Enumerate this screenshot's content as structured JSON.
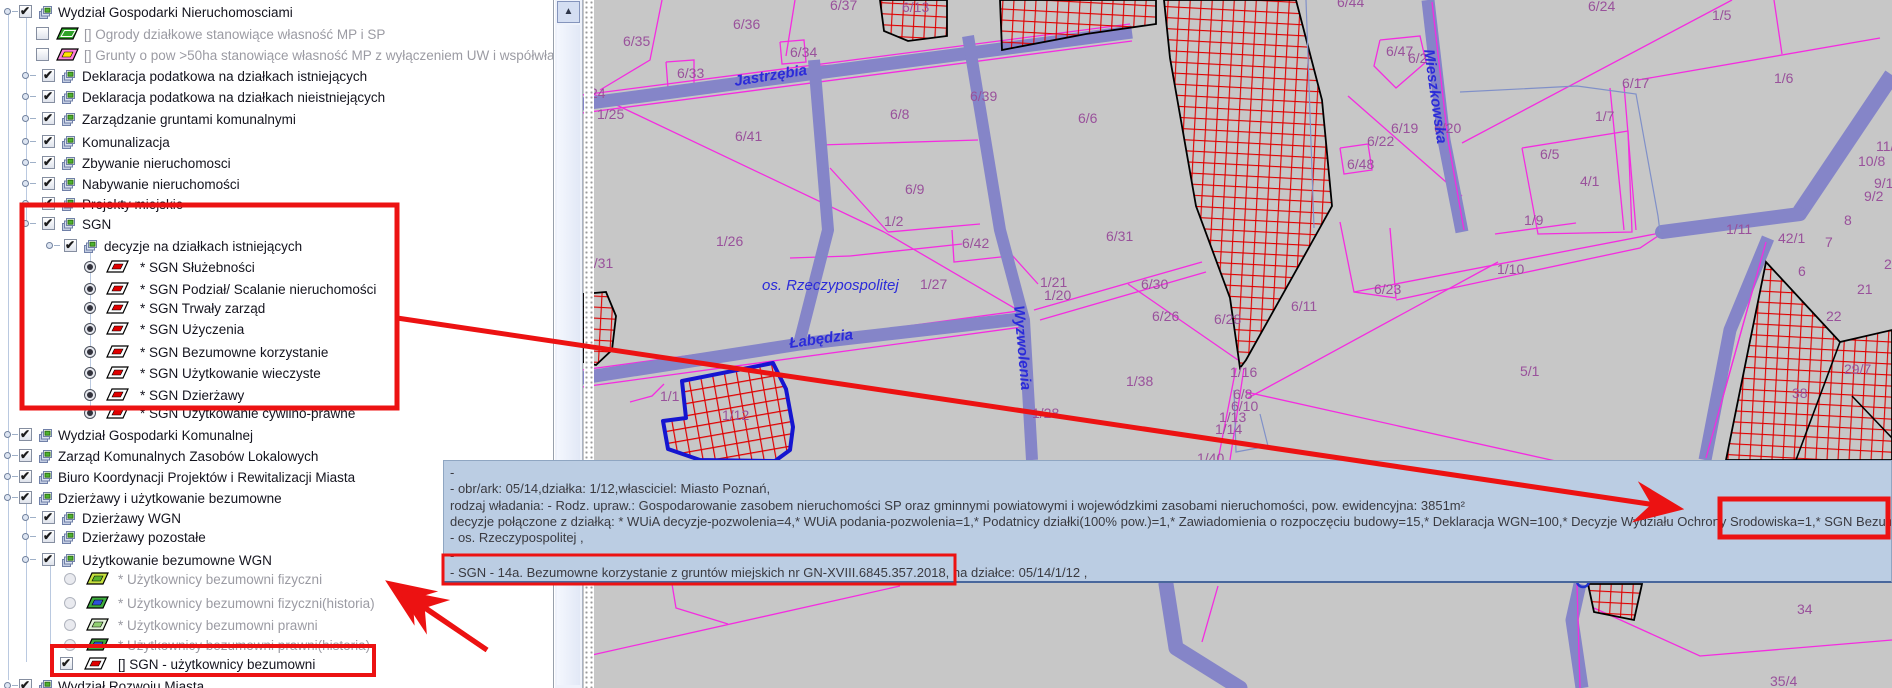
{
  "icons": {
    "scroll_up": "▲"
  },
  "layer_tree": {
    "rows": [
      {
        "y": 3,
        "hx": 4,
        "cx": 19,
        "ix": 37,
        "tx": 58,
        "c": "cb1",
        "icon": "layers",
        "label": "Wydział Gospodarki Nieruchomosciami"
      },
      {
        "y": 25,
        "cx": 36,
        "ix": 52,
        "tx": 84,
        "c": "cb0",
        "icon": "par",
        "f": "#2fa32a",
        "b": null,
        "label": "[] Ogrody działkowe stanowiące własność MP i SP",
        "dis": true
      },
      {
        "y": 46,
        "cx": 36,
        "ix": 52,
        "tx": 84,
        "c": "cb0",
        "icon": "par",
        "f": "#ff80d8",
        "b": "#ffe400",
        "label": "[] Grunty o pow >50ha stanowiące własność MP z wyłączeniem UW i współwłasności",
        "dis": true
      },
      {
        "y": 67,
        "hx": 22,
        "cx": 42,
        "ix": 60,
        "tx": 82,
        "c": "cb1",
        "icon": "layers",
        "label": "Deklaracja podatkowa na działkach istniejących"
      },
      {
        "y": 88,
        "hx": 22,
        "cx": 42,
        "ix": 60,
        "tx": 82,
        "c": "cb1",
        "icon": "layers",
        "label": "Deklaracja podatkowa na działkach nieistniejących"
      },
      {
        "y": 110,
        "hx": 22,
        "cx": 42,
        "ix": 60,
        "tx": 82,
        "c": "cb1",
        "icon": "layers",
        "label": "Zarządzanie gruntami komunalnymi"
      },
      {
        "y": 133,
        "hx": 22,
        "cx": 42,
        "ix": 60,
        "tx": 82,
        "c": "cb1",
        "icon": "layers",
        "label": "Komunalizacja"
      },
      {
        "y": 154,
        "hx": 22,
        "cx": 42,
        "ix": 60,
        "tx": 82,
        "c": "cb1",
        "icon": "layers",
        "label": "Zbywanie nieruchomosci"
      },
      {
        "y": 175,
        "hx": 22,
        "cx": 42,
        "ix": 60,
        "tx": 82,
        "c": "cb1",
        "icon": "layers",
        "label": "Nabywanie nieruchomości"
      },
      {
        "y": 195,
        "hx": 22,
        "cx": 42,
        "ix": 60,
        "tx": 82,
        "c": "cb1",
        "icon": "layers",
        "label": "Projekty miejskie"
      },
      {
        "y": 215,
        "hx": 22,
        "cx": 42,
        "ix": 60,
        "tx": 82,
        "c": "cb1",
        "icon": "layers",
        "label": "SGN"
      },
      {
        "y": 237,
        "hx": 46,
        "cx": 64,
        "ix": 82,
        "tx": 104,
        "c": "cb1",
        "icon": "layers",
        "label": "decyzje na działkach istniejących"
      },
      {
        "y": 258,
        "cx": 84,
        "ix": 102,
        "tx": 140,
        "c": "r1",
        "icon": "par",
        "f": "#ffffff",
        "b": "#e00000",
        "label": "* SGN Służebności"
      },
      {
        "y": 280,
        "cx": 84,
        "ix": 102,
        "tx": 140,
        "c": "r1",
        "icon": "par",
        "f": "#ffffff",
        "b": "#e00000",
        "label": "* SGN Podział/ Scalanie nieruchomości"
      },
      {
        "y": 299,
        "cx": 84,
        "ix": 102,
        "tx": 140,
        "c": "r1",
        "icon": "par",
        "f": "#ffffff",
        "b": "#e00000",
        "label": "* SGN Trwały zarząd"
      },
      {
        "y": 320,
        "cx": 84,
        "ix": 102,
        "tx": 140,
        "c": "r1",
        "icon": "par",
        "f": "#ffffff",
        "b": "#e00000",
        "label": "* SGN Użyczenia"
      },
      {
        "y": 343,
        "cx": 84,
        "ix": 102,
        "tx": 140,
        "c": "r1",
        "icon": "par",
        "f": "#ffffff",
        "b": "#e00000",
        "label": "* SGN Bezumowne korzystanie"
      },
      {
        "y": 364,
        "cx": 84,
        "ix": 102,
        "tx": 140,
        "c": "r1",
        "icon": "par",
        "f": "#ffffff",
        "b": "#e00000",
        "label": "* SGN Użytkowanie wieczyste"
      },
      {
        "y": 386,
        "cx": 84,
        "ix": 102,
        "tx": 140,
        "c": "r1",
        "icon": "par",
        "f": "#ffffff",
        "b": "#e00000",
        "label": "* SGN Dzierżawy"
      },
      {
        "y": 404,
        "cx": 84,
        "ix": 102,
        "tx": 140,
        "c": "r1",
        "icon": "par",
        "f": "#ffffff",
        "b": "#e00000",
        "label": "* SGN Użytkowanie cywilno-prawne"
      },
      {
        "y": 426,
        "hx": 4,
        "cx": 19,
        "ix": 37,
        "tx": 58,
        "c": "cb1",
        "icon": "layers",
        "label": "Wydział Gospodarki Komunalnej"
      },
      {
        "y": 447,
        "hx": 4,
        "cx": 19,
        "ix": 37,
        "tx": 58,
        "c": "cb1",
        "icon": "layers",
        "label": "Zarząd Komunalnych Zasobów Lokalowych"
      },
      {
        "y": 468,
        "hx": 4,
        "cx": 19,
        "ix": 37,
        "tx": 58,
        "c": "cb1",
        "icon": "layers",
        "label": "Biuro Koordynacji Projektów i Rewitalizacji Miasta"
      },
      {
        "y": 489,
        "hx": 4,
        "cx": 19,
        "ix": 37,
        "tx": 58,
        "c": "cb1",
        "icon": "layers",
        "label": "Dzierżawy i użytkowanie bezumowne"
      },
      {
        "y": 509,
        "hx": 22,
        "cx": 42,
        "ix": 60,
        "tx": 82,
        "c": "cb1",
        "icon": "layers",
        "label": "Dzierżawy WGN"
      },
      {
        "y": 528,
        "hx": 22,
        "cx": 42,
        "ix": 60,
        "tx": 82,
        "c": "cb1",
        "icon": "layers",
        "label": "Dzierżawy pozostałe"
      },
      {
        "y": 551,
        "hx": 22,
        "cx": 42,
        "ix": 60,
        "tx": 82,
        "c": "cb1",
        "icon": "layers",
        "label": "Użytkowanie bezumowne WGN"
      },
      {
        "y": 570,
        "cx": 64,
        "ix": 82,
        "tx": 118,
        "c": "r0",
        "icon": "par",
        "f": "#c6e23e",
        "b": "#5bb42c",
        "label": "* Użytkownicy bezumowni fizyczni",
        "dis": true
      },
      {
        "y": 594,
        "cx": 64,
        "ix": 82,
        "tx": 118,
        "c": "r0",
        "icon": "par",
        "f": "#3fae3f",
        "b": "#2d52da",
        "label": "* Użytkownicy bezumowni fizyczni(historia)",
        "dis": true
      },
      {
        "y": 616,
        "cx": 64,
        "ix": 82,
        "tx": 118,
        "c": "r0",
        "icon": "par",
        "f": "#e4f4da",
        "b": "#90d070",
        "label": "* Użytkownicy bezumowni prawni",
        "dis": true
      },
      {
        "y": 636,
        "cx": 64,
        "ix": 82,
        "tx": 118,
        "c": "r0",
        "icon": "par",
        "f": "#3fae3f",
        "b": "#2d52da",
        "label": "* Użytkownicy bezumowni prawni(historia)",
        "dis": true
      },
      {
        "y": 655,
        "cx": 60,
        "ix": 80,
        "tx": 118,
        "c": "cb1",
        "icon": "par",
        "f": "#ffffff",
        "b": "#e00000",
        "label": "[] SGN - użytkownicy bezumowni"
      },
      {
        "y": 677,
        "hx": 4,
        "cx": 19,
        "ix": 37,
        "tx": 58,
        "c": "cb1",
        "icon": "layers",
        "label": "Wydział Rozwoju Miasta"
      }
    ]
  },
  "map": {
    "bg": "#c7c7c7",
    "colors": {
      "parcel_line": "#f42ce0",
      "road": "#8585c8",
      "blue_line": "#8090c8",
      "hatch_border": "#000000",
      "label": "#99519b",
      "street": "#2b2bd9",
      "selected": "#1515d0"
    },
    "roads": [
      {
        "pts": "582,104 870,66 1132,32",
        "w": 13
      },
      {
        "pts": "814,60 828,230 800,340",
        "w": 12
      },
      {
        "pts": "968,36 1000,230 1024,320 1032,460",
        "w": 12
      },
      {
        "pts": "582,378 800,344 1028,318",
        "w": 13
      },
      {
        "pts": "1428,0 1444,140 1462,232",
        "w": 13
      },
      {
        "pts": "1892,75 1800,212",
        "w": 16
      },
      {
        "pts": "1800,214 1662,232",
        "w": 14,
        "cap": "round"
      },
      {
        "pts": "1768,238 1730,330 1705,460",
        "w": 13
      },
      {
        "pts": "1580,584 1572,620 1582,688",
        "w": 13
      },
      {
        "pts": "1166,584 1176,648 1240,688",
        "w": 15,
        "cap": "round"
      }
    ],
    "magenta_lines": [
      {
        "pts": "662,0 650,60 600,90"
      },
      {
        "pts": "795,0 786,56"
      },
      {
        "pts": "666,62 694,60 694,86 668,88 666,62"
      },
      {
        "pts": "780,42 804,40 806,62 782,64 780,42"
      },
      {
        "pts": "585,90 884,232"
      },
      {
        "pts": "884,232 1028,316"
      },
      {
        "pts": "820,66 980,56 1030,46"
      },
      {
        "pts": "820,145 978,140"
      },
      {
        "pts": "830,168 888,232"
      },
      {
        "pts": "888,232 980,224"
      },
      {
        "pts": "850,256 962,244"
      },
      {
        "pts": "952,230 954,262 1010,256"
      },
      {
        "pts": "790,258 850,256"
      },
      {
        "pts": "1034,310 1202,262"
      },
      {
        "pts": "1040,320 1206,272"
      },
      {
        "pts": "1128,284 1238,360"
      },
      {
        "pts": "1236,368 1218,460"
      },
      {
        "pts": "1244,368 1230,460"
      },
      {
        "pts": "1246,392 1560,462"
      },
      {
        "pts": "1248,398 1498,262"
      },
      {
        "pts": "1340,222 1354,292 1396,298 1390,228"
      },
      {
        "pts": "1354,292 1660,233"
      },
      {
        "pts": "1396,300 1640,248 1658,236"
      },
      {
        "pts": "1462,143 1732,0"
      },
      {
        "pts": "1638,80 1880,38"
      },
      {
        "pts": "1782,54 1774,0"
      },
      {
        "pts": "1522,148 1628,131 1632,232 1538,234 1522,148"
      },
      {
        "pts": "1610,88 1624,230"
      },
      {
        "pts": "1624,85 1636,230"
      },
      {
        "pts": "1495,234 1576,223"
      },
      {
        "pts": "592,655 900,586"
      },
      {
        "pts": "672,584 676,608 728,624"
      },
      {
        "pts": "1218,586 1202,642"
      },
      {
        "pts": "1594,608 1700,656 1892,640"
      },
      {
        "pts": "582,95 1130,24"
      },
      {
        "pts": "582,113 1132,41"
      },
      {
        "pts": "582,370 1026,310"
      },
      {
        "pts": "582,387 1022,327"
      },
      {
        "pts": "1766,242 1706,458"
      },
      {
        "pts": "1577,584 1580,688"
      },
      {
        "pts": "1432,2 1448,140 1464,230"
      },
      {
        "pts": "1380,40 1420,36 1426,62 1396,88 1374,66 1380,40"
      },
      {
        "pts": "1340,148 1368,144 1372,170 1344,174 1340,148"
      },
      {
        "pts": "1348,96 1462,196"
      },
      {
        "pts": "630,402 652,396 664,384"
      },
      {
        "pts": "1002,244 1038,284"
      }
    ],
    "blue_lines": [
      {
        "pts": "1306,0 1314,228"
      },
      {
        "pts": "1460,92 1577,86 1636,94 1658,216 1660,232"
      },
      {
        "pts": "1234,390 1236,452 1268,446 1260,414"
      }
    ],
    "blue_ring": {
      "cx": 1583,
      "cy": 581,
      "r": 6
    },
    "hatched_areas": [
      {
        "pts": "880,0 947,0 947,36 908,41 884,31"
      },
      {
        "pts": "1000,0 1156,0 1156,24 1086,34 1002,50"
      },
      {
        "pts": "1164,0 1296,0 1322,100 1332,206 1312,242 1246,360 1240,368 1230,298 1196,206 1170,58"
      },
      {
        "pts": "1766,262 1840,342 1892,330 1892,460 1726,460"
      },
      {
        "pts": "1588,584 1642,584 1634,620 1594,612"
      },
      {
        "pts": "583,294 606,292 616,316 612,350 596,365 583,362"
      }
    ],
    "hatch_extra_lines": [
      {
        "pts": "1840,342 1796,460"
      },
      {
        "pts": "1852,396 1892,438"
      }
    ],
    "selected_parcel": {
      "pts": "682,381 773,363 786,389 793,427 790,450 775,461 700,460 668,449 663,421 686,418"
    },
    "street_labels": [
      {
        "t": "Jastrzębia",
        "x": 735,
        "y": 86,
        "r": -9
      },
      {
        "t": "Łabędzia",
        "x": 790,
        "y": 348,
        "r": -8
      },
      {
        "t": "Wyzwolenia",
        "x": 1014,
        "y": 306,
        "r": 85
      },
      {
        "t": "Mieszkowska",
        "x": 1424,
        "y": 50,
        "r": 82
      },
      {
        "t": "os. Rzeczypospolitej",
        "x": 762,
        "y": 290,
        "r": 0,
        "plain": true
      }
    ],
    "parcel_labels": [
      {
        "t": "6/35",
        "x": 623,
        "y": 46
      },
      {
        "t": "6/36",
        "x": 733,
        "y": 29
      },
      {
        "t": "6/37",
        "x": 830,
        "y": 10
      },
      {
        "t": "6/13",
        "x": 902,
        "y": 12
      },
      {
        "t": "6/33",
        "x": 677,
        "y": 78
      },
      {
        "t": "6/34",
        "x": 790,
        "y": 57
      },
      {
        "t": "24",
        "x": 590,
        "y": 98
      },
      {
        "t": "1/25",
        "x": 597,
        "y": 119
      },
      {
        "t": "6/41",
        "x": 735,
        "y": 141
      },
      {
        "t": "6/8",
        "x": 890,
        "y": 119
      },
      {
        "t": "6/39",
        "x": 970,
        "y": 101
      },
      {
        "t": "6/9",
        "x": 905,
        "y": 194
      },
      {
        "t": "1/2",
        "x": 884,
        "y": 226
      },
      {
        "t": "6/6",
        "x": 1078,
        "y": 123
      },
      {
        "t": "6/44",
        "x": 1337,
        "y": 7
      },
      {
        "t": "6/47",
        "x": 1386,
        "y": 56
      },
      {
        "t": "6/2",
        "x": 1408,
        "y": 63
      },
      {
        "t": "6/19",
        "x": 1391,
        "y": 133
      },
      {
        "t": "6/20",
        "x": 1434,
        "y": 133
      },
      {
        "t": "6/22",
        "x": 1367,
        "y": 146
      },
      {
        "t": "6/48",
        "x": 1347,
        "y": 169
      },
      {
        "t": "6/24",
        "x": 1588,
        "y": 11
      },
      {
        "t": "1/5",
        "x": 1712,
        "y": 20
      },
      {
        "t": "1/6",
        "x": 1774,
        "y": 83
      },
      {
        "t": "6/17",
        "x": 1622,
        "y": 88
      },
      {
        "t": "1/7",
        "x": 1595,
        "y": 121
      },
      {
        "t": "6/5",
        "x": 1540,
        "y": 159
      },
      {
        "t": "4/1",
        "x": 1580,
        "y": 186
      },
      {
        "t": "1/9",
        "x": 1524,
        "y": 225
      },
      {
        "t": "1/11",
        "x": 1726,
        "y": 234
      },
      {
        "t": "42/1",
        "x": 1778,
        "y": 243
      },
      {
        "t": "7",
        "x": 1825,
        "y": 247
      },
      {
        "t": "11/1",
        "x": 1876,
        "y": 151
      },
      {
        "t": "10/8",
        "x": 1858,
        "y": 166
      },
      {
        "t": "9/1",
        "x": 1874,
        "y": 188
      },
      {
        "t": "9/2",
        "x": 1864,
        "y": 201
      },
      {
        "t": "8",
        "x": 1844,
        "y": 225
      },
      {
        "t": "6",
        "x": 1798,
        "y": 276
      },
      {
        "t": "20",
        "x": 1884,
        "y": 269
      },
      {
        "t": "21",
        "x": 1857,
        "y": 294
      },
      {
        "t": "22",
        "x": 1826,
        "y": 321
      },
      {
        "t": "29/7",
        "x": 1844,
        "y": 374
      },
      {
        "t": "38",
        "x": 1792,
        "y": 398
      },
      {
        "t": "5/1",
        "x": 1520,
        "y": 376
      },
      {
        "t": "1/10",
        "x": 1497,
        "y": 274
      },
      {
        "t": "1/26",
        "x": 716,
        "y": 246
      },
      {
        "t": "6/42",
        "x": 962,
        "y": 248
      },
      {
        "t": "1/27",
        "x": 920,
        "y": 289
      },
      {
        "t": "1/21",
        "x": 1040,
        "y": 287
      },
      {
        "t": "1/20",
        "x": 1044,
        "y": 300
      },
      {
        "t": "1/31",
        "x": 586,
        "y": 268
      },
      {
        "t": "1/1",
        "x": 660,
        "y": 401
      },
      {
        "t": "1/12",
        "x": 722,
        "y": 420
      },
      {
        "t": "1/28",
        "x": 1032,
        "y": 418
      },
      {
        "t": "6/31",
        "x": 1106,
        "y": 241
      },
      {
        "t": "6/30",
        "x": 1141,
        "y": 289
      },
      {
        "t": "6/26",
        "x": 1152,
        "y": 321
      },
      {
        "t": "6/28",
        "x": 1214,
        "y": 324
      },
      {
        "t": "6/11",
        "x": 1291,
        "y": 311
      },
      {
        "t": "6/23",
        "x": 1374,
        "y": 294
      },
      {
        "t": "1/38",
        "x": 1126,
        "y": 386
      },
      {
        "t": "1/16",
        "x": 1230,
        "y": 377
      },
      {
        "t": "6/8",
        "x": 1233,
        "y": 399
      },
      {
        "t": "6/10",
        "x": 1231,
        "y": 411
      },
      {
        "t": "1/13",
        "x": 1219,
        "y": 422
      },
      {
        "t": "1/14",
        "x": 1215,
        "y": 434
      },
      {
        "t": "1/40",
        "x": 1197,
        "y": 463
      },
      {
        "t": "34",
        "x": 1797,
        "y": 614
      },
      {
        "t": "35/4",
        "x": 1770,
        "y": 686
      }
    ]
  },
  "tooltip": {
    "bg": "#bbcde3",
    "lines": [
      {
        "y": 4,
        "text": "-"
      },
      {
        "y": 20,
        "text": "- obr/ark: 05/14,działka: 1/12,własciciel: Miasto Poznań,"
      },
      {
        "y": 37,
        "text": "rodzaj władania: - Rodz. upraw.: Gospodarowanie zasobem nieruchomości SP oraz gminnymi powiatowymi i wojewódzkimi zasobami nieruchomości, pow. ewidencyjna: 3851m²"
      },
      {
        "y": 53,
        "text": "decyzje połączone z działką: * WUiA decyzje-pozwolenia=4,* WUiA podania-pozwolenia=1,* Podatnicy działki(100% pow.)=1,* Zawiadomienia o rozpoczęciu budowy=15,* Deklaracja WGN=100,* Decyzje Wydziału Ochrony Srodowiska=1,* SGN Bezumowne korzystanie="
      },
      {
        "y": 69,
        "text": "- os. Rzeczypospolitej ,"
      },
      {
        "y": 87,
        "text": "-"
      },
      {
        "y": 104,
        "text": "- SGN - 14a. Bezumowne korzystanie z gruntów miejskich nr GN-XVIII.6845.357.2018, na działce: 05/14/1/12 ,"
      }
    ]
  },
  "annotations": {
    "color": "#ec1212",
    "rects": [
      {
        "x": 22,
        "y": 205,
        "w": 375,
        "h": 203,
        "bw": 5,
        "name": "sgn-layer-group-highlight"
      },
      {
        "x": 52,
        "y": 646,
        "w": 322,
        "h": 29,
        "bw": 4,
        "name": "sgn-bezumowni-item-highlight"
      },
      {
        "x": 1720,
        "y": 499,
        "w": 168,
        "h": 38,
        "bw": 5,
        "name": "tooltip-sgn-value-highlight"
      },
      {
        "x": 443,
        "y": 555,
        "w": 512,
        "h": 29,
        "bw": 3,
        "name": "tooltip-sgn-line-highlight"
      }
    ],
    "arrows": [
      {
        "x1": 397,
        "y1": 318,
        "x2": 1676,
        "y2": 508,
        "w": 5
      },
      {
        "x1": 487,
        "y1": 650,
        "x2": 392,
        "y2": 585,
        "w": 5
      },
      {
        "x1": 487,
        "y1": 650,
        "x2": 404,
        "y2": 594,
        "w": 5
      }
    ]
  }
}
